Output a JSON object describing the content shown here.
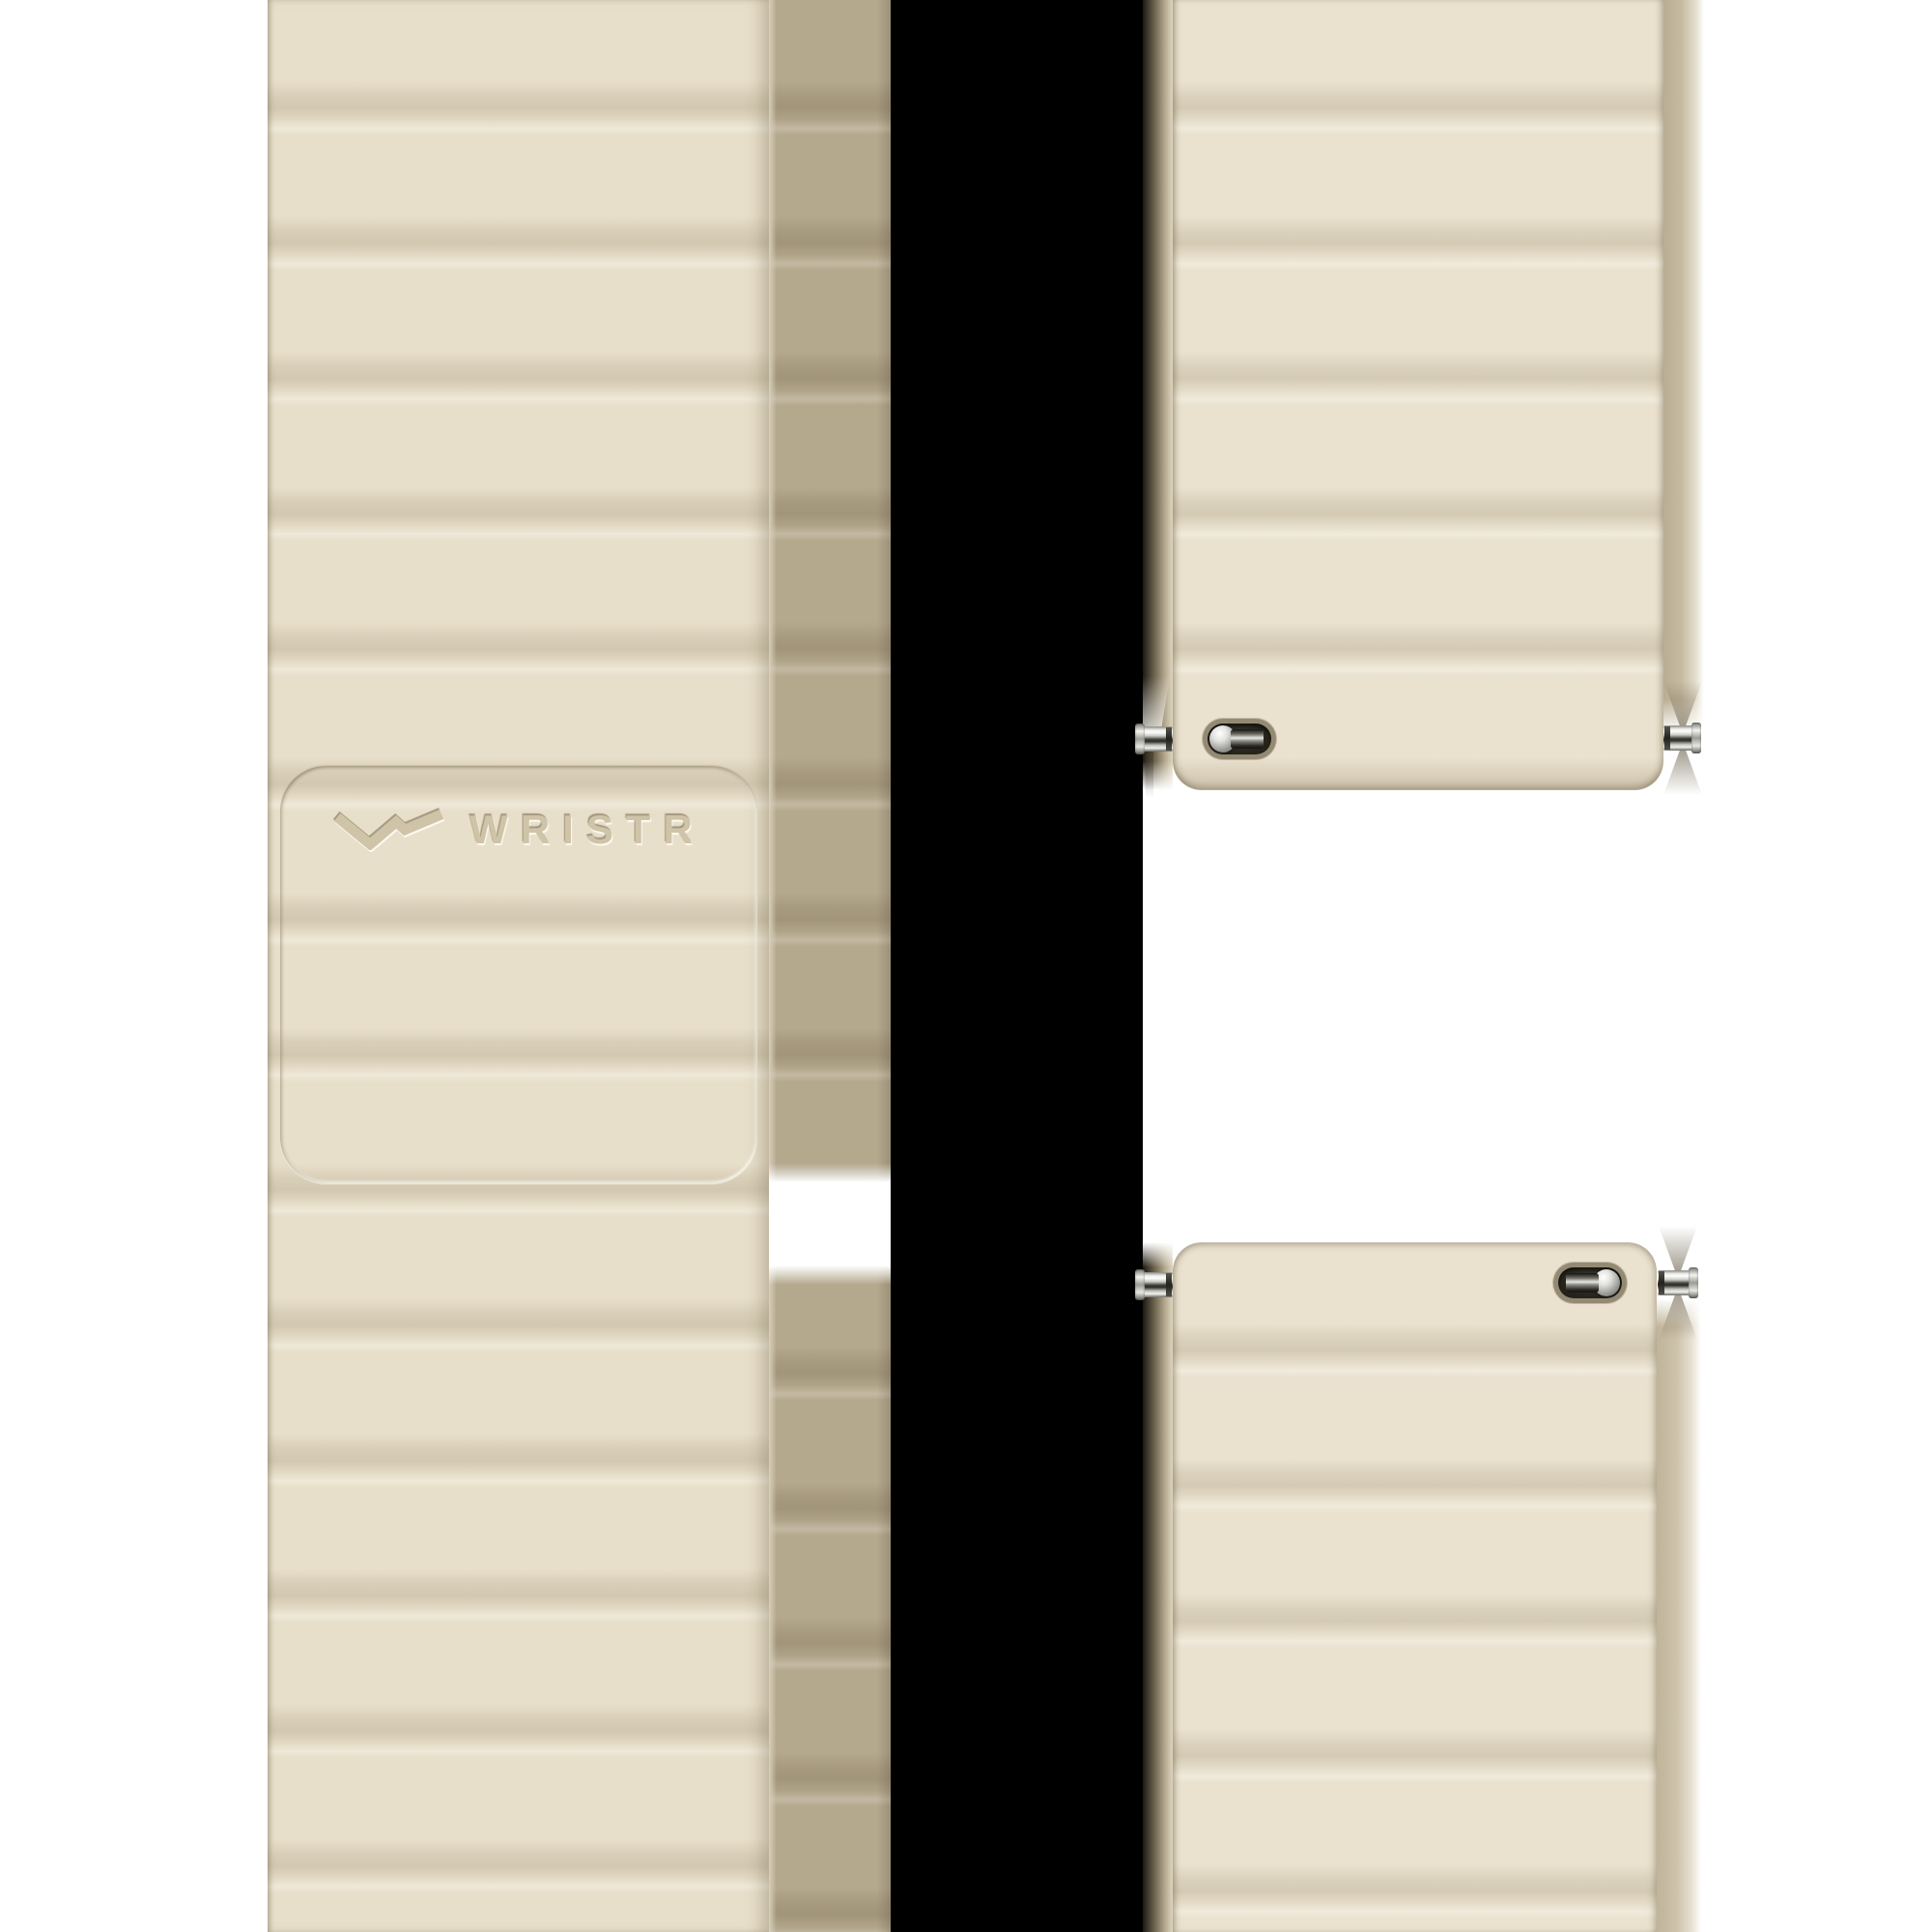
{
  "brand": {
    "logo_text": "WRISTR",
    "logo_mark": "w-chevron-icon"
  },
  "product": {
    "type": "watch-strap-product-photo",
    "pieces": [
      "front-strap-with-embossed-logo",
      "upper-back-piece-with-spring-bar-pins-and-quick-release-slot",
      "lower-back-piece-with-spring-bar-pins-and-quick-release-slot"
    ]
  },
  "colors": {
    "background": "#ffffff",
    "strap_beige": "#e8dfca",
    "ridge_shadow": "#d7cbb2",
    "side_shadow_taupe": "#b4a88d",
    "divider_black": "#000000",
    "metal_silver": "#e8e8e4",
    "metal_dark": "#3a3a36",
    "slot_ring": "#948a74",
    "slot_cavity": "#262319",
    "logo_deboss": "#cfc3a8"
  }
}
